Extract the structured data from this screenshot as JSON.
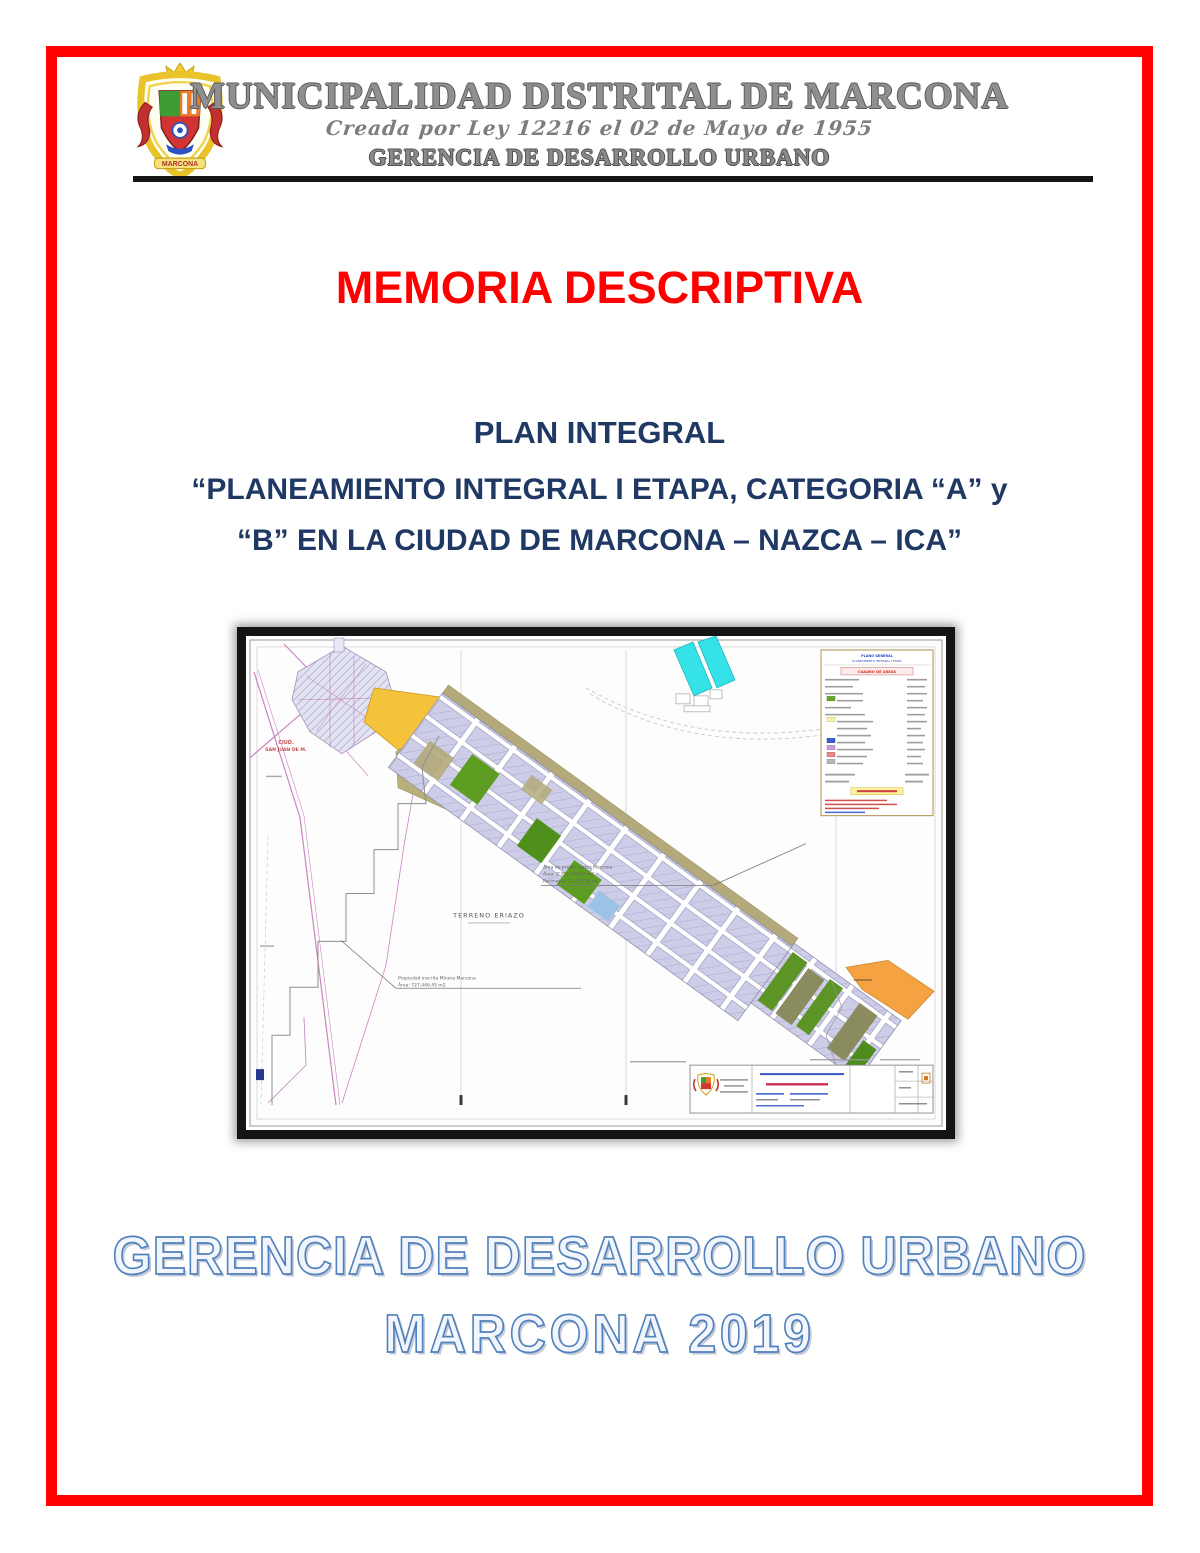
{
  "header": {
    "municipality": "MUNICIPALIDAD DISTRITAL DE MARCONA",
    "creation_law": "Creada por Ley 12216 el 02 de Mayo de 1955",
    "office": "GERENCIA DE DESARROLLO URBANO",
    "logo_banner": "MARCONA"
  },
  "document": {
    "title": "MEMORIA DESCRIPTIVA",
    "plan_label": "PLAN INTEGRAL",
    "plan_name_line1": "“PLANEAMIENTO INTEGRAL I ETAPA, CATEGORIA “A” y",
    "plan_name_line2": "“B” EN LA CIUDAD DE MARCONA – NAZCA – ICA”"
  },
  "map": {
    "terrain_label": "TERRENO ERIAZO",
    "red_label_line1": "CIUD.",
    "red_label_line2": "SAN JUAN DE M.",
    "legend_title_line1": "PLANO GENERAL",
    "legend_title_line2": "PLANEAMIENTO INTEGRAL I ETAPA",
    "legend_header": "CUADRO DE AREAS",
    "annotation_a_line1": "Área de predio matriz Marcona",
    "annotation_a_line2": "Área: 2'354,449.97 m2",
    "annotation_a_line3": "Perímetro: 12,753.56 ml",
    "annotation_b_line1": "Propiedad inscrita Minera Marcona",
    "annotation_b_line2": "Área: 727,446.45 m2"
  },
  "footer": {
    "office": "GERENCIA DE DESARROLLO URBANO",
    "city_year": "MARCONA 2019"
  },
  "colors": {
    "frame_red": "#fe0000",
    "title_red": "#ff0000",
    "navy": "#1f3864",
    "footer_blue": "#4f81bd",
    "header_gray": "#8f8f8f"
  }
}
